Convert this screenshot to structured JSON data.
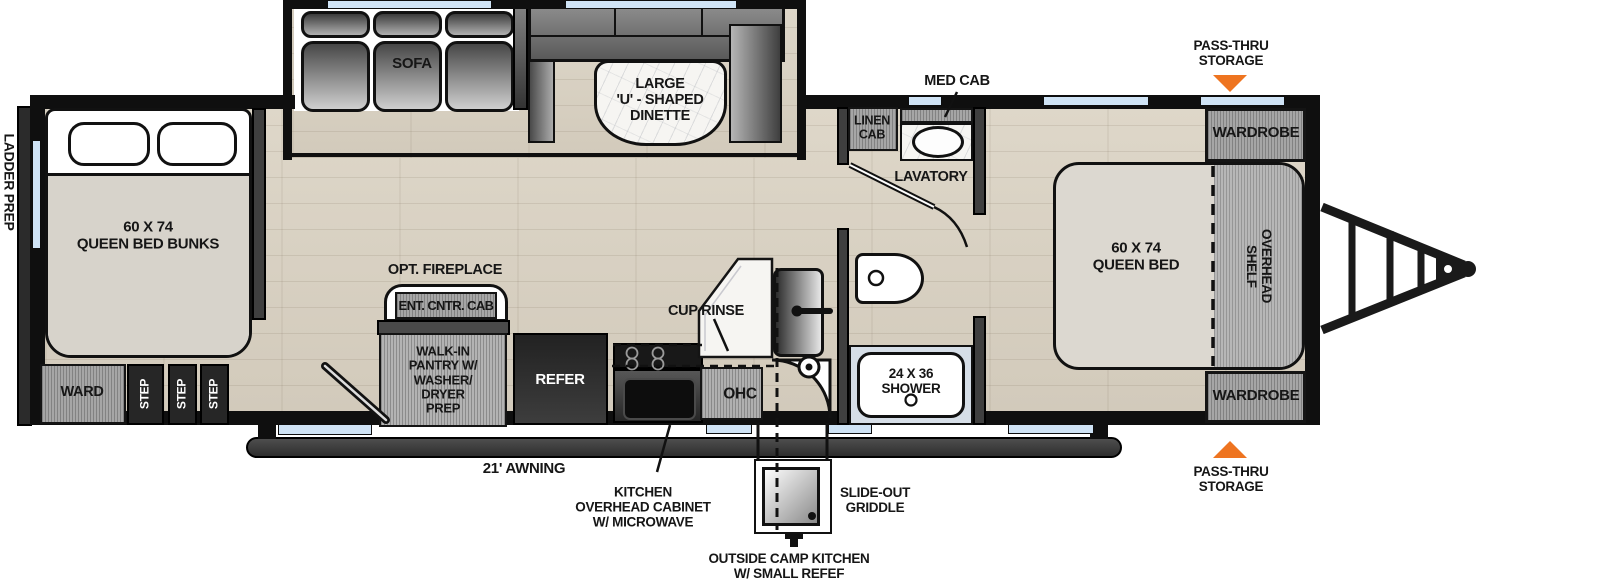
{
  "colors": {
    "accent_orange": "#EE7420",
    "window_blue": "#CFE3F5",
    "wall_black": "#0F0F0F",
    "floor_wood": "#DAD3C5",
    "bed_beige": "#DCD8D0"
  },
  "callouts": {
    "ladder_prep": "LADDER PREP",
    "pass_thru_top": "PASS-THRU\nSTORAGE",
    "pass_thru_bottom": "PASS-THRU\nSTORAGE",
    "awning": "21' AWNING",
    "kitchen_ohc": "KITCHEN\nOVERHEAD CABINET\nW/ MICROWAVE",
    "slide_out_griddle": "SLIDE-OUT\nGRIDDLE",
    "camp_kitchen": "OUTSIDE CAMP KITCHEN\nW/ SMALL REFEF",
    "med_cab": "MED CAB",
    "cup_rinse": "CUP RINSE",
    "opt_fireplace": "OPT. FIREPLACE"
  },
  "rooms": {
    "bunks": "60 X 74\nQUEEN BED BUNKS",
    "ward": "WARD",
    "step": "STEP",
    "sofa": "SOFA",
    "dinette": "LARGE\n'U' - SHAPED\nDINETTE",
    "ent_cntr_cab": "ENT. CNTR. CAB",
    "pantry": "WALK-IN\nPANTRY W/\nWASHER/\nDRYER\nPREP",
    "refer": "REFER",
    "ohc": "OHC",
    "linen_cab": "LINEN\nCAB",
    "lavatory": "LAVATORY",
    "shower": "24 X 36\nSHOWER",
    "wardrobe_top": "WARDROBE",
    "wardrobe_bottom": "WARDROBE",
    "overhead_shelf": "OVERHEAD\nSHELF",
    "queen_bed": "60 X 74\nQUEEN BED"
  }
}
